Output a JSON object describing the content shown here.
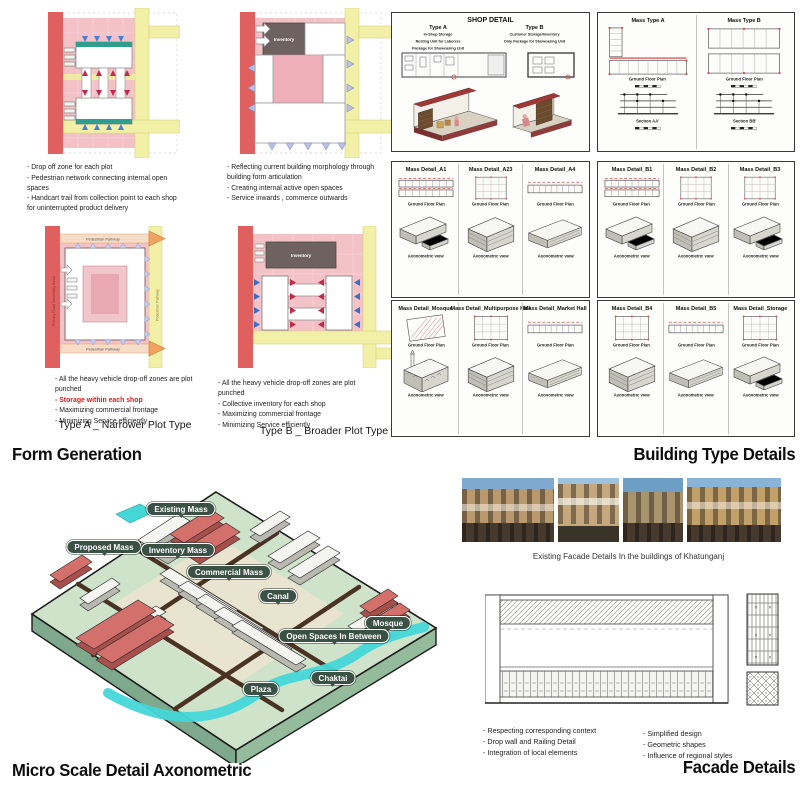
{
  "form_generation": {
    "heading": "Form Generation",
    "inventory_label": "Inventory",
    "d1_bullets": [
      "- Drop off zone for each plot",
      "- Pedestrian network connecting internal open spaces",
      "- Handcart trail from collection point to each shop for uninterrupted product delivery"
    ],
    "d2_bullets": [
      "- Reflecting current building morphology through building form articulation",
      "- Creating internal active open spaces",
      "- Service inwards , commerce outwards"
    ],
    "type_a": {
      "caption": "Type A _ Narrower Plot Type",
      "road_top": "Pedestrian Pathway",
      "road_bottom": "Pedestrian Pathway",
      "road_right": "Pedestrian Pathway",
      "road_left": "Primary Road Secondary Road",
      "bullets": [
        "- All the heavy vehicle drop-off zones are plot punched",
        "- Storage within each shop",
        "- Maximizing commercial frontage",
        "- Minimizing Service efficiently"
      ]
    },
    "type_b": {
      "caption": "Type B _ Broader Plot Type",
      "bullets": [
        "- All the heavy vehicle drop-off zones are plot punched",
        "- Collective inventory for each shop",
        "- Maximizing commercial frontage",
        "- Minimizing Service efficiently"
      ]
    }
  },
  "building_type_details": {
    "heading": "Building Type Details",
    "shop": {
      "title": "SHOP DETAIL",
      "a_title": "Type A",
      "a_sub1": "In-Shop Storage",
      "a_sub2": "Resting Unit for Laborers",
      "a_sub3": "Package for Showcasing Unit",
      "b_title": "Type B",
      "b_sub1": "Customer Storage/Inventory",
      "b_sub2": "Only Package for Showcasing Unit"
    },
    "mass_type": {
      "a": "Mass Type A",
      "b": "Mass Type B",
      "gfp": "Ground Floor Plan",
      "sec_a": "Section AA'",
      "sec_b": "Section BB'"
    },
    "gfp": "Ground Floor Plan",
    "axon": "Axonometric view",
    "panels": [
      [
        "Mass Detail_A1",
        "Mass Detail_A23",
        "Mass Detail_A4"
      ],
      [
        "Mass Detail_B1",
        "Mass Detail_B2",
        "Mass Detail_B3"
      ],
      [
        "Mass Detail_Mosque",
        "Mass Detail_Multipurpose Hall",
        "Mass Detail_Market Hall"
      ],
      [
        "Mass Detail_B4",
        "Mass Detail_B5",
        "Mass Detail_Storage"
      ]
    ]
  },
  "micro_axon": {
    "heading": "Micro Scale Detail Axonometric",
    "labels": [
      "Existing Mass",
      "Proposed Mass",
      "Inventory Mass",
      "Commercial Mass",
      "Canal",
      "Mosque",
      "Open Spaces In Between",
      "Chaktai",
      "Plaza"
    ]
  },
  "facade_details": {
    "heading": "Facade Details",
    "photos_caption": "Existing Facade Details In the buildings of Khatunganj",
    "bullets_left": [
      "- Respecting corresponding context",
      "- Drop wall and Railing Detail",
      "- Integration of local elements"
    ],
    "bullets_right": [
      "- Simplified design",
      "- Geometric shapes",
      "- Influence of regional styles"
    ]
  },
  "colors": {
    "plot_pink": "#f3c2c6",
    "road_red": "#e05f5f",
    "road_yellow": "#f2efa6",
    "teal_strip": "#2f9e8f",
    "label_green": "#3c5146",
    "water_cyan": "#45d7d8",
    "building_red": "#d4706c"
  }
}
